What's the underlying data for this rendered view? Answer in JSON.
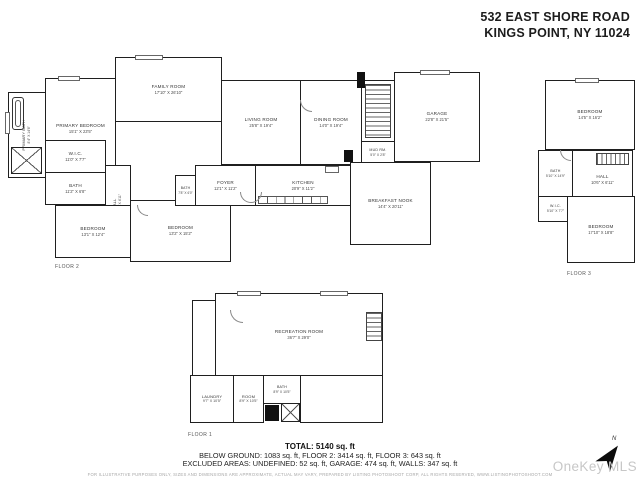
{
  "header": {
    "address_line1": "532 EAST SHORE ROAD",
    "address_line2": "KINGS POINT, NY 11024"
  },
  "floor2": {
    "label": "FLOOR 2",
    "rooms": {
      "primary_bedroom": {
        "name": "PRIMARY BEDROOM",
        "dims": "15'1\" X 23'5\""
      },
      "family_room": {
        "name": "FAMILY ROOM",
        "dims": "17'10\" X 26'10\""
      },
      "living_room": {
        "name": "LIVING ROOM",
        "dims": "25'8\" X 19'4\""
      },
      "dining_room": {
        "name": "DINING ROOM",
        "dims": "14'0\" X 19'4\""
      },
      "garage": {
        "name": "GARAGE",
        "dims": "22'8\" X 21'5\""
      },
      "primary_bath": {
        "name": "PRIMARY BATH",
        "dims": "8'4\" X 14'6\""
      },
      "wic": {
        "name": "W.I.C.",
        "dims": "11'0\" X 7'7\""
      },
      "bath": {
        "name": "BATH",
        "dims": "11'2\" X 6'8\""
      },
      "hall": {
        "name": "HALL",
        "dims": "14'4\" X 4'11\""
      },
      "bedroom_west": {
        "name": "BEDROOM",
        "dims": "13'1\" X 12'4\""
      },
      "bedroom_south": {
        "name": "BEDROOM",
        "dims": "13'2\" X 15'2\""
      },
      "foyer": {
        "name": "FOYER",
        "dims": "12'1\" X 11'2\""
      },
      "powder_bath": {
        "name": "BATH",
        "dims": "7'8\" X 6'0\""
      },
      "kitchen": {
        "name": "KITCHEN",
        "dims": "20'9\" X 11'2\""
      },
      "breakfast_nook": {
        "name": "BREAKFAST NOOK",
        "dims": "14'4\" X 20'11\""
      },
      "mud_room": {
        "name": "MUD RM.",
        "dims": "5'0\" X 2'8\""
      }
    }
  },
  "floor3": {
    "label": "FLOOR 3",
    "rooms": {
      "bedroom_north": {
        "name": "BEDROOM",
        "dims": "14'5\" X 16'2\""
      },
      "bath": {
        "name": "BATH",
        "dims": "5'10\" X 14'9\""
      },
      "hall": {
        "name": "HALL",
        "dims": "10'6\" X 6'11\""
      },
      "wic": {
        "name": "W.I.C.",
        "dims": "5'10\" X 7'7\""
      },
      "bedroom_south": {
        "name": "BEDROOM",
        "dims": "17'10\" X 18'8\""
      }
    }
  },
  "floor1": {
    "label": "FLOOR 1",
    "rooms": {
      "recreation_room": {
        "name": "RECREATION ROOM",
        "dims": "36'7\" X 29'0\""
      },
      "laundry": {
        "name": "LAUNDRY",
        "dims": "9'7\" X 10'5\""
      },
      "room": {
        "name": "ROOM",
        "dims": "8'9\" X 10'5\""
      },
      "bath": {
        "name": "BATH",
        "dims": "8'9\" X 10'5\""
      }
    }
  },
  "summary": {
    "total": "TOTAL: 5140 sq. ft",
    "floors": "BELOW GROUND: 1083 sq. ft, FLOOR 2: 3414 sq. ft, FLOOR 3: 643 sq. ft",
    "excluded": "EXCLUDED AREAS: UNDEFINED: 52 sq. ft, GARAGE: 474 sq. ft, WALLS: 347 sq. ft",
    "disclaimer": "FOR ILLUSTRATIVE PURPOSES ONLY, SIZES AND DIMENSIONS ARE APPROXIMATE, ACTUAL MAY VARY, PREPARED BY LISTING PHOTOSHOOT CORP, ALL RIGHTS RESERVED, WWW.LISTINGPHOTOSHOOT.COM"
  },
  "compass": {
    "north_label": "N"
  },
  "watermark": "OneKey MLS"
}
